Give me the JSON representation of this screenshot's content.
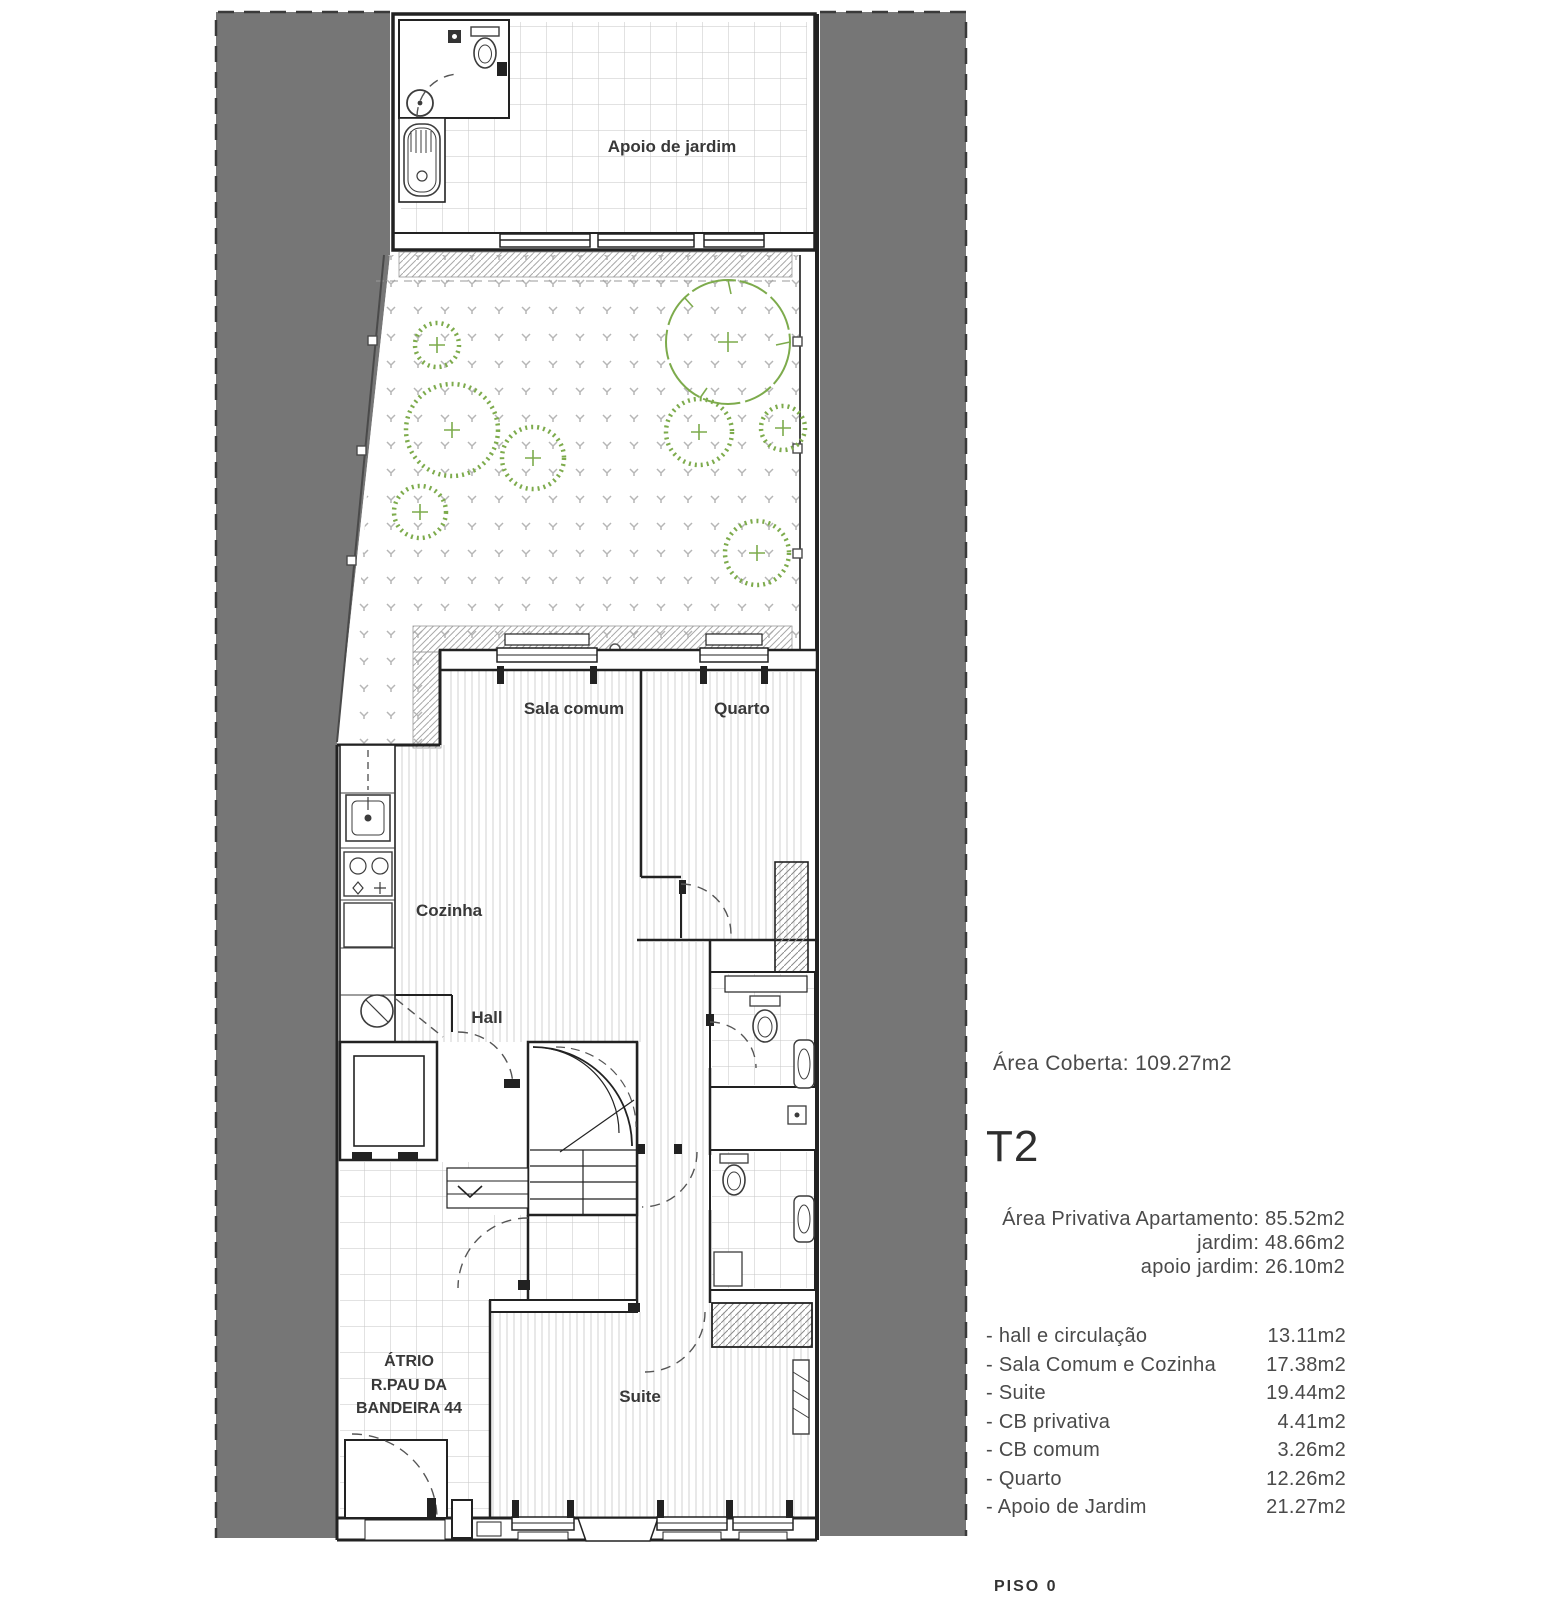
{
  "plan_labels": {
    "apoio": "Apoio de jardim",
    "sala": "Sala comum",
    "quarto": "Quarto",
    "cozinha": "Cozinha",
    "hall": "Hall",
    "suite": "Suite",
    "atrio": [
      "ÁTRIO",
      "R.PAU DA",
      "BANDEIRA 44"
    ]
  },
  "info": {
    "area_coberta": "Área Coberta: 109.27m2",
    "typology": "T2",
    "private": {
      "line1": "Área Privativa Apartamento: 85.52m2",
      "line2": "jardim: 48.66m2",
      "line3": "apoio jardim:  26.10m2"
    },
    "rooms": [
      {
        "label": "- hall e circulação",
        "value": "13.11m2"
      },
      {
        "label": "- Sala Comum e Cozinha",
        "value": "17.38m2"
      },
      {
        "label": "- Suite",
        "value": "19.44m2"
      },
      {
        "label": "- CB privativa",
        "value": "4.41m2"
      },
      {
        "label": "- CB comum",
        "value": "3.26m2"
      },
      {
        "label": "- Quarto",
        "value": "12.26m2"
      },
      {
        "label": "- Apoio de Jardim",
        "value": "21.27m2"
      }
    ],
    "floor": "PISO 0"
  },
  "colors": {
    "site_gray": "#767676",
    "tree_green": "#7dab4c",
    "wall_line": "#222222",
    "text_gray": "#4a4a4a"
  }
}
